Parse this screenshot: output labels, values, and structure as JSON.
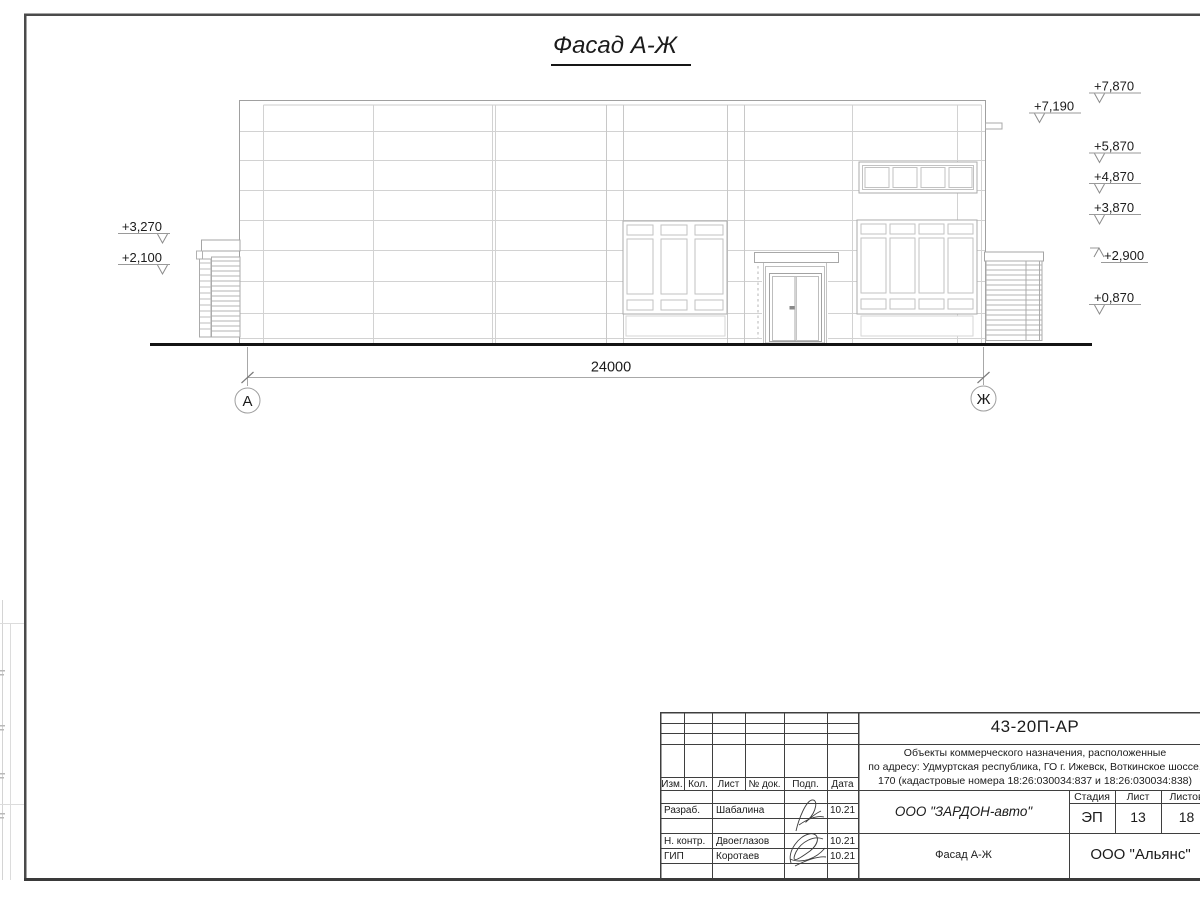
{
  "drawing": {
    "title": "Фасад А-Ж",
    "dimension_total": "24000",
    "axes": {
      "left": "А",
      "right": "Ж"
    },
    "elevations_left": [
      {
        "label": "+3,270"
      },
      {
        "label": "+2,100"
      }
    ],
    "elevations_right": [
      {
        "label": "+7,870"
      },
      {
        "label": "+7,190"
      },
      {
        "label": "+5,870"
      },
      {
        "label": "+4,870"
      },
      {
        "label": "+3,870"
      },
      {
        "label": "+2,900"
      },
      {
        "label": "+0,870"
      }
    ]
  },
  "title_block": {
    "doc_number": "43-20П-АР",
    "project_description": [
      "Объекты коммерческого назначения, расположенные",
      "по адресу: Удмуртская республика, ГО г. Ижевск, Воткинское шоссе,",
      "170 (кадастровые номера 18:26:030034:837 и 18:26:030034:838)"
    ],
    "columns": {
      "izm": "Изм.",
      "kol": "Кол.",
      "list": "Лист",
      "doc": "№ док.",
      "podp": "Подп.",
      "data": "Дата"
    },
    "roles": [
      {
        "role": "Разраб.",
        "name": "Шабалина",
        "date": "10.21"
      },
      {
        "role": "Н. контр.",
        "name": "Двоеглазов",
        "date": "10.21"
      },
      {
        "role": "ГИП",
        "name": "Коротаев",
        "date": "10.21"
      }
    ],
    "company": "ООО \"ЗАРДОН-авто\"",
    "stage": {
      "header_stage": "Стадия",
      "header_sheet": "Лист",
      "header_sheets": "Листов",
      "stage": "ЭП",
      "sheet": "13",
      "sheets": "18"
    },
    "sheet_title": "Фасад А-Ж",
    "organization": "ООО \"Альянс\""
  },
  "colors": {
    "line_dark": "#1b1b1b",
    "line_frame": "#4a4a4a",
    "line_outline": "#a0a0a0",
    "line_grid": "#d2d2d2"
  }
}
